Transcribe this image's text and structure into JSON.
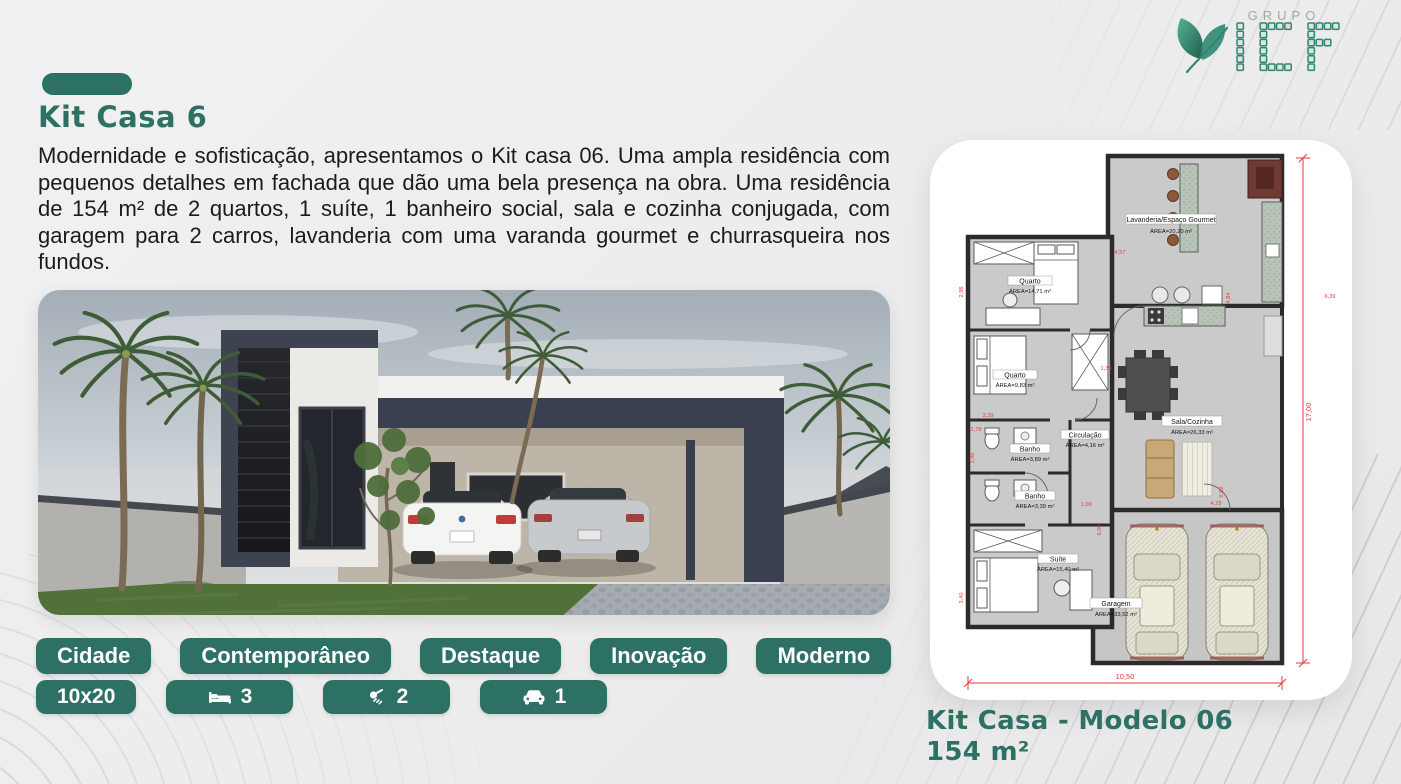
{
  "logo": {
    "grupo": "GRUPO",
    "name": "ICF"
  },
  "header": {
    "title": "Kit Casa 6"
  },
  "description": "Modernidade e sofisticação, apresentamos o Kit casa 06. Uma ampla residência com pequenos detalhes em fachada que dão uma bela presença na obra. Uma residência de 154 m² de 2 quartos, 1 suíte, 1 banheiro social, sala e cozinha conjugada, com garagem para 2 carros, lavanderia com uma varanda gourmet e churrasqueira nos fundos.",
  "tags": {
    "row1": [
      "Cidade",
      "Contemporâneo",
      "Destaque",
      "Inovação",
      "Moderno"
    ]
  },
  "details": {
    "size": "10x20",
    "beds": "3",
    "showers": "2",
    "cars": "1"
  },
  "plan": {
    "rooms": [
      {
        "name": "Lavanderia/Espaço Gourmet",
        "area": "ÁREA=20,20 m²"
      },
      {
        "name": "Quarto",
        "area": "ÁREA=14,71 m²"
      },
      {
        "name": "Quarto",
        "area": "ÁREA=9,83 m²"
      },
      {
        "name": "Banho",
        "area": "ÁREA=3,89 m²"
      },
      {
        "name": "Circulação",
        "area": "ÁREA=4,16 m²"
      },
      {
        "name": "Banho",
        "area": "ÁREA=3,39 m²"
      },
      {
        "name": "Sala/Cozinha",
        "area": "ÁREA=26,33 m²"
      },
      {
        "name": "Suíte",
        "area": "ÁREA=15,40 m²"
      },
      {
        "name": "Garagem",
        "area": "ÁREA=33,52 m²"
      }
    ],
    "dims": {
      "total_height": "17,00",
      "total_width": "10,50"
    },
    "small_dims": [
      "4,57",
      "6,39",
      "4,84",
      "2,96",
      "3,39",
      "2,78",
      "1,40",
      "3,40",
      "1,00",
      "6,00",
      "4,29",
      "0,82",
      "1,39"
    ]
  },
  "footer": {
    "model": "Kit Casa - Modelo 06",
    "area": "154 m²"
  },
  "colors": {
    "green": "#2c7163",
    "logo_green": "#2f8871",
    "dim_red": "#e23b3b"
  }
}
